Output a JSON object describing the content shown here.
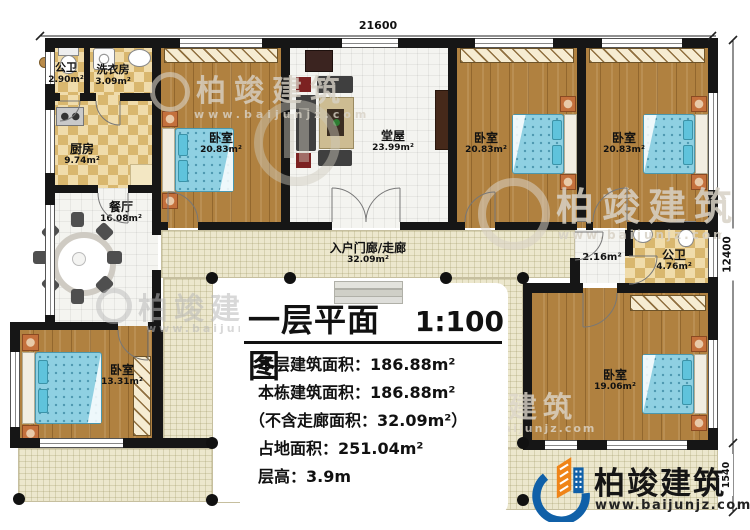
{
  "dimensions": {
    "top": "21600",
    "right": "12400",
    "right_segment": "1540"
  },
  "rooms": {
    "bath_top": {
      "name": "公卫",
      "area": "2.90m²"
    },
    "laundry": {
      "name": "洗衣房",
      "area": "3.09m²"
    },
    "kitchen": {
      "name": "厨房",
      "area": "9.74m²"
    },
    "bedroom_tl": {
      "name": "卧室",
      "area": "20.83m²"
    },
    "hall": {
      "name": "堂屋",
      "area": "23.99m²"
    },
    "bedroom_tm": {
      "name": "卧室",
      "area": "20.83m²"
    },
    "bedroom_tr": {
      "name": "卧室",
      "area": "20.83m²"
    },
    "dining": {
      "name": "餐厅",
      "area": "16.08m²"
    },
    "corridor": {
      "name": "入户门廊/走廊",
      "area": "32.09m²"
    },
    "vestibule": {
      "area": "2.16m²"
    },
    "bath_right": {
      "name": "公卫",
      "area": "4.76m²"
    },
    "bedroom_bl": {
      "name": "卧室",
      "area": "13.31m²"
    },
    "bedroom_br": {
      "name": "卧室",
      "area": "19.06m²"
    }
  },
  "title_block": {
    "title": "一层平面图",
    "scale": "1:100",
    "lines": [
      "本层建筑面积：186.88m²",
      "本栋建筑面积：186.88m²",
      "（不含走廊面积：32.09m²）",
      "占地面积：251.04m²",
      "层高：3.9m"
    ]
  },
  "watermark": {
    "brand": "柏竣建筑",
    "url": "www.baijunjz.com"
  },
  "logo": {
    "brand": "柏竣建筑",
    "url": "www.baijunjz.com"
  },
  "colors": {
    "accent_blue": "#1060a8",
    "accent_orange": "#ef8418",
    "wall": "#161616"
  }
}
